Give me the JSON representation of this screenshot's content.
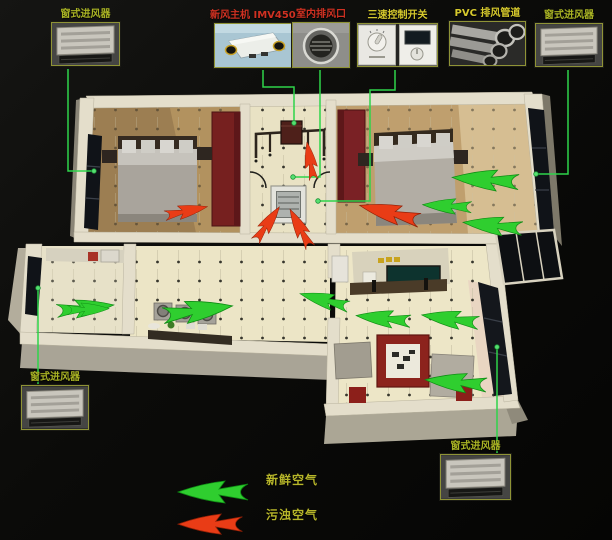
{
  "colors": {
    "background": "#0b0b09",
    "fresh": "#2fce2f",
    "fresh_edge": "#0f8c14",
    "polluted": "#e93c16",
    "polluted_edge": "#8f1f06",
    "connector": "#2ed44a",
    "connector_dot": "#55e070",
    "label_green": "#a9b324",
    "label_red": "#cf3122",
    "label_yellow": "#d6c92d",
    "legend_text": "#b7b62a",
    "wall": "#e4decb",
    "wardrobe_red": "#7a2125",
    "floor_cream": "#ece5c6",
    "floor_wood": "#b2905f"
  },
  "cards": [
    {
      "id": "window-inlet-top-left",
      "label": "窗式进风器",
      "device": "window-inlet",
      "label_color": "#a9b324"
    },
    {
      "id": "fresh-air-unit",
      "label": "新风主机 IMV450",
      "device": "fresh-air-main-unit",
      "label_color": "#cf3122"
    },
    {
      "id": "indoor-exhaust-vent",
      "label": "室内排风口",
      "device": "round-exhaust-vent",
      "label_color": "#cf3122"
    },
    {
      "id": "speed-switch",
      "label": "三速控制开关",
      "device": "three-speed-control-switch",
      "label_color": "#d6c92d"
    },
    {
      "id": "pvc-duct",
      "label": "PVC 排风管道",
      "device": "pvc-exhaust-pipes",
      "label_color": "#d6c92d"
    },
    {
      "id": "window-inlet-top-right",
      "label": "窗式进风器",
      "device": "window-inlet",
      "label_color": "#a9b324"
    },
    {
      "id": "window-inlet-left",
      "label": "窗式进风器",
      "device": "window-inlet",
      "label_color": "#a9b324"
    },
    {
      "id": "window-inlet-bottom-right",
      "label": "窗式进风器",
      "device": "window-inlet",
      "label_color": "#a9b324"
    }
  ],
  "legend": {
    "items": [
      {
        "kind": "fresh",
        "label": "新鲜空气"
      },
      {
        "kind": "polluted",
        "label": "污浊空气"
      }
    ]
  },
  "diagram": {
    "arrows": [
      {
        "kind": "fresh",
        "x": 453,
        "y": 167,
        "rot": 4,
        "sx": 0.95,
        "sy": 0.95
      },
      {
        "kind": "fresh",
        "x": 423,
        "y": 197,
        "rot": 3,
        "sx": 0.7,
        "sy": 0.7
      },
      {
        "kind": "fresh",
        "x": 464,
        "y": 213,
        "rot": 6,
        "sx": 0.85,
        "sy": 0.85
      },
      {
        "kind": "fresh",
        "x": 113,
        "y": 296,
        "rot": -6,
        "sx": -0.82,
        "sy": 0.82
      },
      {
        "kind": "fresh",
        "x": 109,
        "y": 302,
        "rot": -2,
        "sx": -0.6,
        "sy": 0.6
      },
      {
        "kind": "fresh",
        "x": 231,
        "y": 295,
        "rot": -8,
        "sx": -1.0,
        "sy": 1.0
      },
      {
        "kind": "fresh",
        "x": 302,
        "y": 286,
        "rot": 15,
        "sx": 0.72,
        "sy": 0.72
      },
      {
        "kind": "fresh",
        "x": 357,
        "y": 307,
        "rot": 6,
        "sx": 0.78,
        "sy": 0.78
      },
      {
        "kind": "fresh",
        "x": 423,
        "y": 306,
        "rot": 8,
        "sx": 0.82,
        "sy": 0.82
      },
      {
        "kind": "fresh",
        "x": 426,
        "y": 370,
        "rot": 5,
        "sx": 0.88,
        "sy": 0.88
      },
      {
        "kind": "fresh",
        "x": 178,
        "y": 481,
        "rot": 0,
        "sx": 1.0,
        "sy": 1.0
      },
      {
        "kind": "polluted",
        "x": 206,
        "y": 200,
        "rot": -12,
        "sx": -0.62,
        "sy": 0.62
      },
      {
        "kind": "polluted",
        "x": 362,
        "y": 196,
        "rot": 14,
        "sx": 0.88,
        "sy": 0.88
      },
      {
        "kind": "polluted",
        "x": 274,
        "y": 203,
        "rot": -55,
        "sx": -0.6,
        "sy": 0.6
      },
      {
        "kind": "polluted",
        "x": 296,
        "y": 206,
        "rot": 62,
        "sx": 0.62,
        "sy": 0.62
      },
      {
        "kind": "polluted",
        "x": 301,
        "y": 143,
        "rot": -100,
        "sx": -0.55,
        "sy": 0.55
      },
      {
        "kind": "polluted",
        "x": 178,
        "y": 514,
        "rot": 0,
        "sx": 0.92,
        "sy": 0.92
      }
    ],
    "connectors": [
      {
        "to": "window-inlet-top-left",
        "points": "68,69 68,171 94,171",
        "dot": [
          94,
          171
        ]
      },
      {
        "to": "fresh-air-unit",
        "points": "263,70 263,87 294,87 294,123",
        "dot": [
          294,
          123
        ]
      },
      {
        "to": "indoor-exhaust-vent",
        "points": "320,70 320,177 293,177",
        "dot": [
          293,
          177
        ]
      },
      {
        "to": "speed-switch",
        "points": "395,70 395,90 370,90 370,201 318,201",
        "dot": [
          318,
          201
        ]
      },
      {
        "to": "window-inlet-top-right",
        "points": "568,70 568,174 536,174",
        "dot": [
          536,
          174
        ]
      },
      {
        "to": "window-inlet-left",
        "points": "38,288 38,391",
        "dot": [
          38,
          288
        ]
      },
      {
        "to": "window-inlet-bottom-right",
        "points": "497,347 497,455",
        "dot": [
          497,
          347
        ]
      }
    ]
  }
}
